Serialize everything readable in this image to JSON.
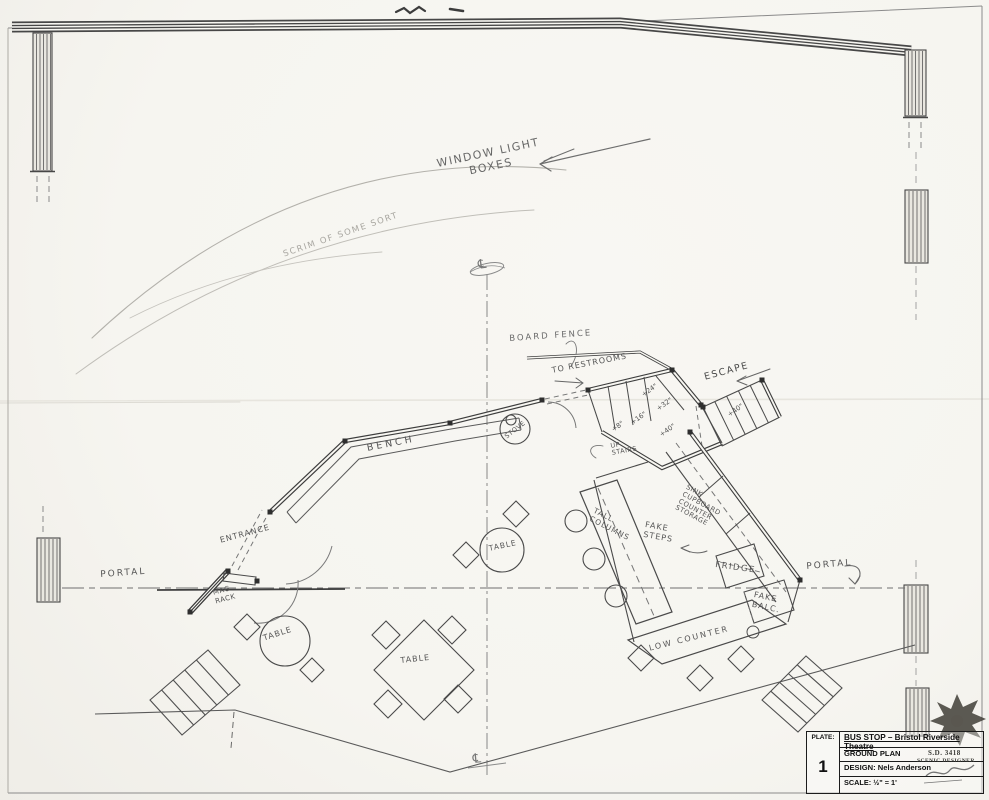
{
  "title_block": {
    "plate_label": "PLATE:",
    "plate_number": "1",
    "show_title": "BUS STOP – Bristol Riverside Theatre",
    "drawing_title": "GROUND PLAN",
    "design": "DESIGN:  Nels Anderson",
    "scale": "SCALE:  ½\" = 1'",
    "stamp_number": "S.D. 3418",
    "stamp_title": "SCENIC DESIGNER"
  },
  "annotations": {
    "window_light_boxes": "WINDOW LIGHT\nBOXES",
    "scrim_note": "SCRIM OF SOME SORT",
    "board_fence": "BOARD FENCE",
    "to_restrooms": "TO RESTROOMS",
    "escape": "ESCAPE",
    "bench": "BENCH",
    "stove": "STOVE",
    "entrance": "ENTRANCE",
    "mag_rack": "MAG\nRACK",
    "portal_left": "PORTAL",
    "portal_right": "PORTAL",
    "table_center": "TABLE",
    "table_left": "TABLE",
    "table_square": "TABLE",
    "tall_columns": "TALL\nCOLUMNS",
    "fake_steps": "FAKE\nSTEPS",
    "sink_storage": "SINK\nCUPBOARD\nCOUNTER\nSTORAGE",
    "fridge": "FRIDGE",
    "fake_balc": "FAKE\nBALC.",
    "low_counter": "LOW COUNTER",
    "up_stairs": "UP\nSTAIRS",
    "centerline_top": "℄",
    "centerline_bottom": "℄"
  },
  "measurements": {
    "r8": "+8\"",
    "r16": "+16\"",
    "r24": "+24\"",
    "r32": "+32\"",
    "plat40": "+40\"",
    "esc40": "+40\""
  },
  "colors": {
    "pencil": "#5f5f5f",
    "dark_pencil": "#3d3d3d",
    "faint": "#b3b1ab",
    "ink": "#1c1c1c",
    "paper": "#f7f6f1"
  }
}
